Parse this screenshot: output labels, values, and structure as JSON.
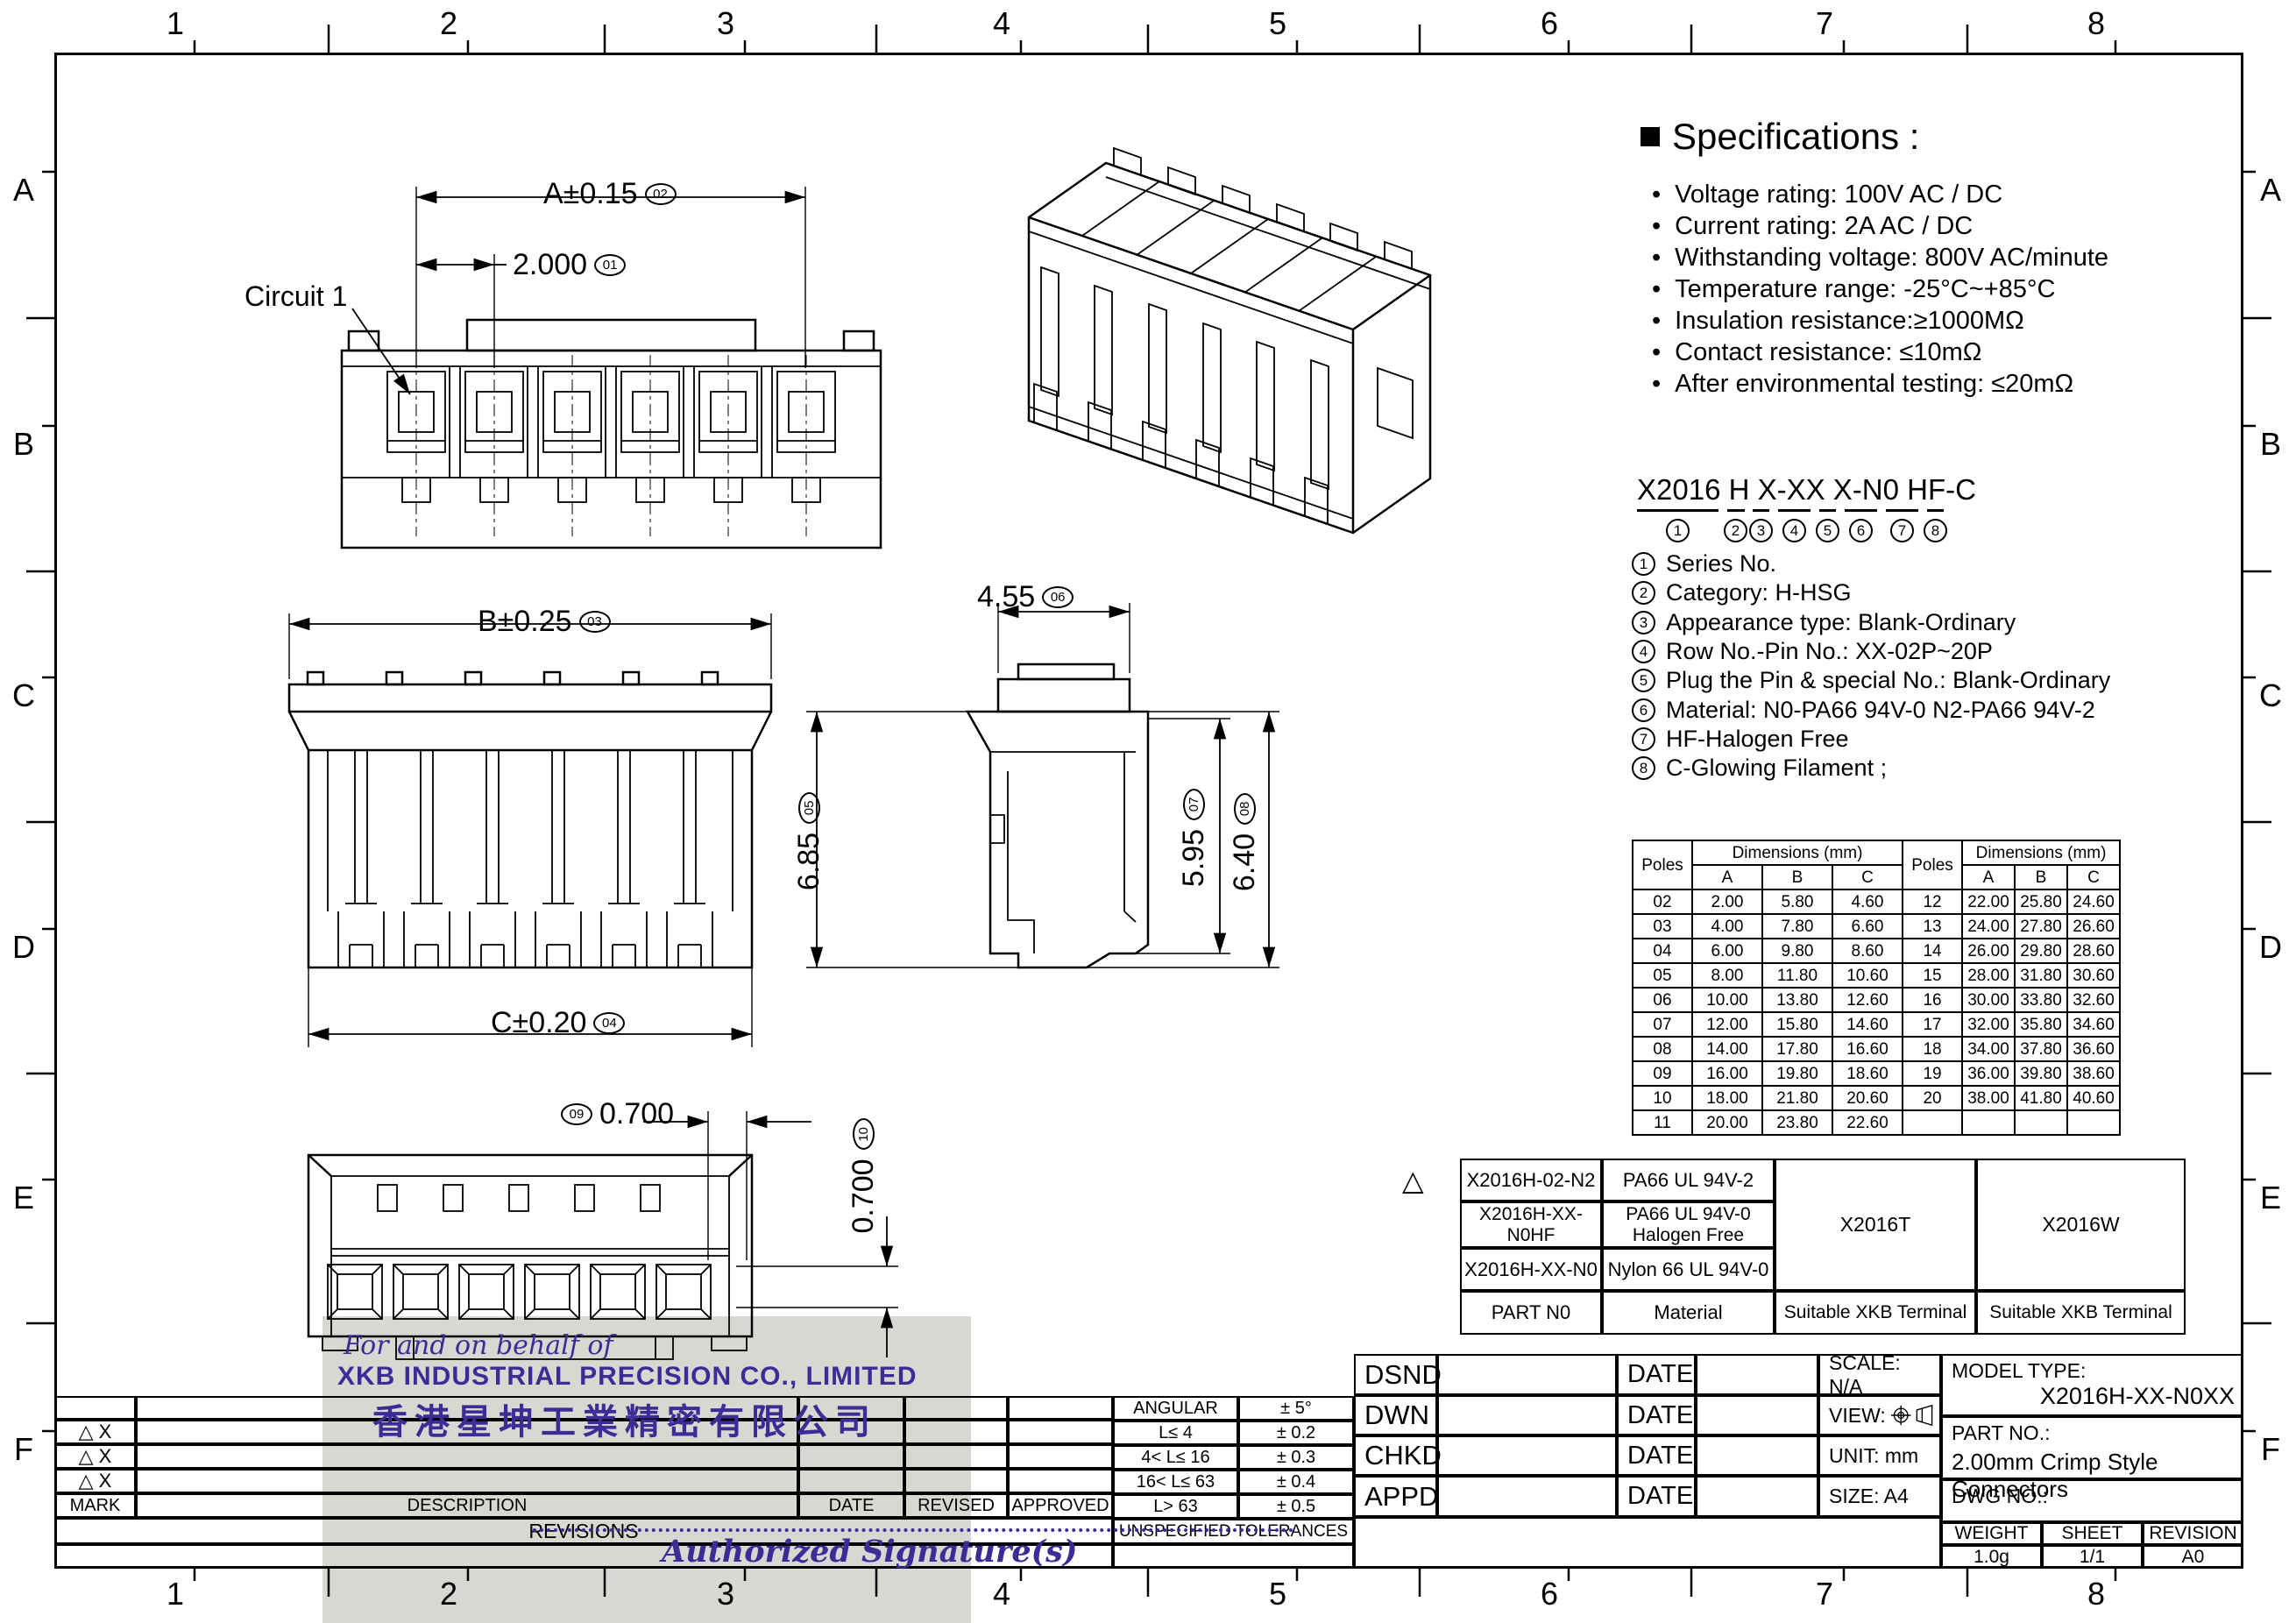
{
  "sheet": {
    "grid_cols": [
      "1",
      "2",
      "3",
      "4",
      "5",
      "6",
      "7",
      "8"
    ],
    "grid_rows": [
      "A",
      "B",
      "C",
      "D",
      "E",
      "F"
    ]
  },
  "icons": {
    "square_bullet": "■",
    "dot_bullet": "•",
    "triangle": "△",
    "revision_mark": "△ X"
  },
  "specifications": {
    "title": "Specifications :",
    "items": [
      "Voltage rating: 100V AC / DC",
      "Current rating:  2A  AC / DC",
      "Withstanding voltage: 800V AC/minute",
      "Temperature range: -25°C~+85°C",
      "Insulation resistance:≥1000MΩ",
      "Contact resistance: ≤10mΩ",
      "After environmental testing:  ≤20mΩ"
    ]
  },
  "part_code": {
    "code": "X2016 H X-XX X-N0 HF-C",
    "digits": [
      "1",
      "2",
      "3",
      "4",
      "5",
      "6",
      "7",
      "8"
    ],
    "legend": [
      {
        "num": "1",
        "text": "Series No."
      },
      {
        "num": "2",
        "text": "Category:  H-HSG"
      },
      {
        "num": "3",
        "text": "Appearance type:  Blank-Ordinary"
      },
      {
        "num": "4",
        "text": "Row No.-Pin No.:  XX-02P~20P"
      },
      {
        "num": "5",
        "text": "Plug the Pin & special No.:  Blank-Ordinary"
      },
      {
        "num": "6",
        "text": "Material:  N0-PA66 94V-0   N2-PA66 94V-2"
      },
      {
        "num": "7",
        "text": "HF-Halogen Free"
      },
      {
        "num": "8",
        "text": "C-Glowing Filament ;"
      }
    ]
  },
  "dim_labels": {
    "circuit1": "Circuit 1",
    "A_text": "A±0.15",
    "A_tag": "02",
    "pitch_text": "2.000",
    "pitch_tag": "01",
    "B_text": "B±0.25",
    "B_tag": "03",
    "C_text": "C±0.20",
    "C_tag": "04",
    "h685_text": "6.85",
    "h685_tag": "05",
    "d455_text": "4.55",
    "d455_tag": "06",
    "h595_text": "5.95",
    "h595_tag": "07",
    "h640_text": "6.40",
    "h640_tag": "08",
    "p700a_text": "0.700",
    "p700a_tag": "09",
    "p700b_text": "0.700",
    "p700b_tag": "10"
  },
  "dim_table": {
    "poles_label": "Poles",
    "dims_header": "Dimensions (mm)",
    "col_headers": [
      "A",
      "B",
      "C"
    ],
    "rows": [
      [
        "02",
        "2.00",
        "5.80",
        "4.60",
        "12",
        "22.00",
        "25.80",
        "24.60"
      ],
      [
        "03",
        "4.00",
        "7.80",
        "6.60",
        "13",
        "24.00",
        "27.80",
        "26.60"
      ],
      [
        "04",
        "6.00",
        "9.80",
        "8.60",
        "14",
        "26.00",
        "29.80",
        "28.60"
      ],
      [
        "05",
        "8.00",
        "11.80",
        "10.60",
        "15",
        "28.00",
        "31.80",
        "30.60"
      ],
      [
        "06",
        "10.00",
        "13.80",
        "12.60",
        "16",
        "30.00",
        "33.80",
        "32.60"
      ],
      [
        "07",
        "12.00",
        "15.80",
        "14.60",
        "17",
        "32.00",
        "35.80",
        "34.60"
      ],
      [
        "08",
        "14.00",
        "17.80",
        "16.60",
        "18",
        "34.00",
        "37.80",
        "36.60"
      ],
      [
        "09",
        "16.00",
        "19.80",
        "18.60",
        "19",
        "36.00",
        "39.80",
        "38.60"
      ],
      [
        "10",
        "18.00",
        "21.80",
        "20.60",
        "20",
        "38.00",
        "41.80",
        "40.60"
      ],
      [
        "11",
        "20.00",
        "23.80",
        "22.60",
        "",
        "",
        "",
        ""
      ]
    ]
  },
  "material_table": {
    "rows": [
      {
        "part": "X2016H-02-N2",
        "material": "PA66 UL 94V-2"
      },
      {
        "part": "X2016H-XX-N0HF",
        "material": "PA66  UL 94V-0\nHalogen Free"
      },
      {
        "part": "X2016H-XX-N0",
        "material": "Nylon 66  UL 94V-0"
      }
    ],
    "terminal_t": "X2016T",
    "terminal_w": "X2016W",
    "footer_part": "PART N0",
    "footer_material": "Material",
    "footer_terminal": "Suitable XKB Terminal"
  },
  "title_block": {
    "labels": [
      "DSND",
      "DWN",
      "CHKD",
      "APPD"
    ],
    "date_label": "DATE",
    "scale": "SCALE: N/A",
    "view_label": "VIEW:",
    "unit": "UNIT:  mm",
    "size": "SIZE:  A4",
    "model_type_label": "MODEL TYPE:",
    "model_type": "X2016H-XX-N0XX",
    "part_no_label": "PART NO.:",
    "part_no": "2.00mm Crimp Style Connectors",
    "dwg_no_label": "DWG NO.:",
    "weight_label": "WEIGHT",
    "sheet_label": "SHEET",
    "revision_label": "REVISION",
    "weight": "1.0g",
    "sheet": "1/1",
    "revision": "A0"
  },
  "tolerances": {
    "rows": [
      [
        "ANGULAR",
        "± 5°"
      ],
      [
        "L≤ 4",
        "± 0.2"
      ],
      [
        "4< L≤ 16",
        "± 0.3"
      ],
      [
        "16< L≤ 63",
        "± 0.4"
      ],
      [
        "L> 63",
        "± 0.5"
      ]
    ],
    "footer": "UNSPECIFIED  TOLERANCES"
  },
  "revisions": {
    "headers": [
      "MARK",
      "DESCRIPTION",
      "DATE",
      "REVISED",
      "APPROVED"
    ],
    "footer": "REVISIONS"
  },
  "stamp": {
    "line1": "For and on behalf of",
    "line2": "XKB INDUSTRIAL PRECISION CO., LIMITED",
    "line3": "香港星坤工業精密有限公司",
    "line4": "Authorized Signature(s)"
  },
  "colors": {
    "line": "#000000",
    "stamp_purple": "#3c2d96",
    "scan_gray": "#d8d7d2"
  }
}
